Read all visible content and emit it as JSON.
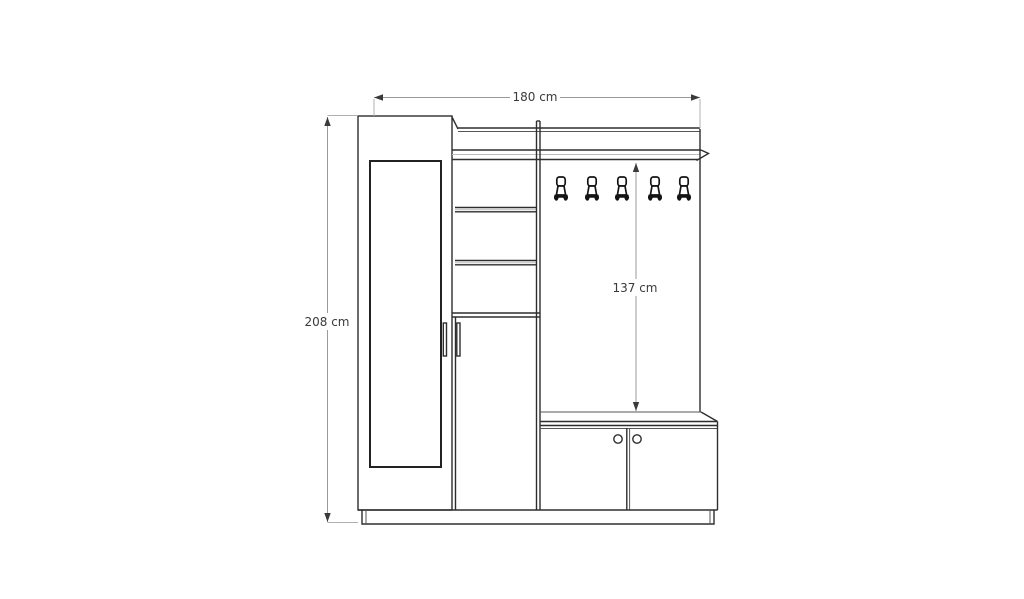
{
  "page": {
    "background": "#ffffff",
    "kind": "furniture front-elevation technical drawing"
  },
  "annotations": {
    "total_width": {
      "label": "180 cm",
      "value": 180,
      "unit": "cm",
      "orientation": "horizontal"
    },
    "total_height": {
      "label": "208 cm",
      "value": 208,
      "unit": "cm",
      "orientation": "vertical"
    },
    "panel_height": {
      "label": "137 cm",
      "value": 137,
      "unit": "cm",
      "orientation": "vertical"
    }
  },
  "features": {
    "coat_hooks": 5,
    "open_shelves": 3,
    "wardrobe_doors_with_mirror": 1,
    "tall_cabinet_doors": 1,
    "bench_doors": 2,
    "door_knobs": 2
  },
  "colors": {
    "outline": "#2e2e2e",
    "dimension_line": "#9a9a9a",
    "arrowhead": "#3a3a3a",
    "label_text": "#3a3a3c",
    "background": "#ffffff"
  }
}
